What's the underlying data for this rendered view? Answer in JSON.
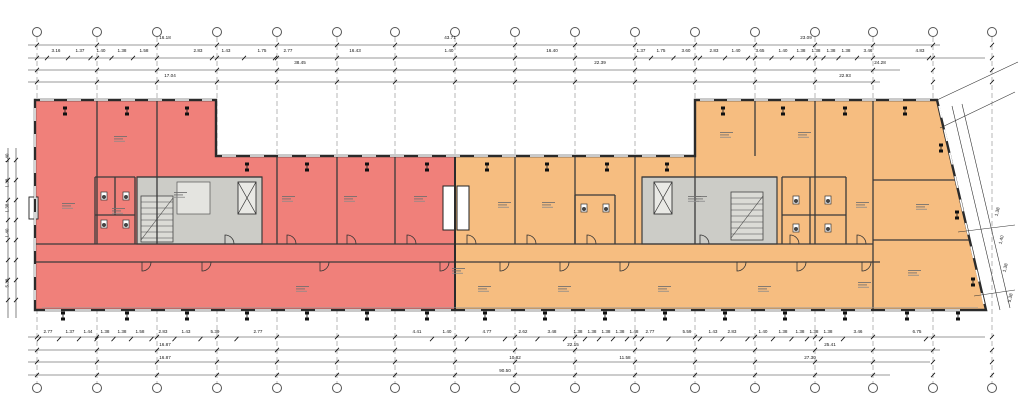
{
  "drawing": {
    "kind": "architectural-floor-plan",
    "zones": [
      {
        "id": "west-wing",
        "color": "#f0807a"
      },
      {
        "id": "east-wing",
        "color": "#f6bd80"
      }
    ],
    "core_color": "#ccccc7",
    "stair_color": "#dbdbd6",
    "grid_bubble_count": 17
  },
  "dimensions": {
    "top_rows": [
      {
        "y": 39,
        "chain": false,
        "labels": [
          {
            "t": "16.18",
            "x": 165
          },
          {
            "t": "43.71",
            "x": 450
          },
          {
            "t": "23.09",
            "x": 806
          }
        ]
      },
      {
        "y": 52,
        "chain": true,
        "labels": [
          {
            "t": "3.16",
            "x": 56
          },
          {
            "t": "1.37",
            "x": 80
          },
          {
            "t": "1.40",
            "x": 101
          },
          {
            "t": "1.38",
            "x": 122
          },
          {
            "t": "1.58",
            "x": 144
          },
          {
            "t": "2.83",
            "x": 198
          },
          {
            "t": "1.43",
            "x": 226
          },
          {
            "t": "1.75",
            "x": 262
          },
          {
            "t": "2.77",
            "x": 288
          },
          {
            "t": "16.43",
            "x": 355
          },
          {
            "t": "1.40",
            "x": 449
          },
          {
            "t": "16.40",
            "x": 552
          },
          {
            "t": "1.37",
            "x": 641
          },
          {
            "t": "1.75",
            "x": 661
          },
          {
            "t": "3.60",
            "x": 686
          },
          {
            "t": "2.83",
            "x": 714
          },
          {
            "t": "1.40",
            "x": 736
          },
          {
            "t": "3.65",
            "x": 760
          },
          {
            "t": "1.40",
            "x": 783
          },
          {
            "t": "1.38",
            "x": 801
          },
          {
            "t": "1.38",
            "x": 816
          },
          {
            "t": "1.38",
            "x": 831
          },
          {
            "t": "1.38",
            "x": 846
          },
          {
            "t": "3.46",
            "x": 868
          },
          {
            "t": "4.83",
            "x": 920
          }
        ]
      },
      {
        "y": 64,
        "chain": false,
        "labels": [
          {
            "t": "38.45",
            "x": 300
          },
          {
            "t": "22.39",
            "x": 600
          },
          {
            "t": "24.28",
            "x": 880
          }
        ]
      },
      {
        "y": 77,
        "chain": false,
        "labels": [
          {
            "t": "17.04",
            "x": 170
          },
          {
            "t": "22.93",
            "x": 845
          }
        ]
      }
    ],
    "bottom_rows": [
      {
        "y": 333,
        "chain": true,
        "labels": [
          {
            "t": "2.77",
            "x": 48
          },
          {
            "t": "1.37",
            "x": 70
          },
          {
            "t": "1.44",
            "x": 88
          },
          {
            "t": "1.38",
            "x": 105
          },
          {
            "t": "1.38",
            "x": 122
          },
          {
            "t": "1.58",
            "x": 140
          },
          {
            "t": "2.83",
            "x": 163
          },
          {
            "t": "1.43",
            "x": 186
          },
          {
            "t": "5.39",
            "x": 215
          },
          {
            "t": "2.77",
            "x": 258
          },
          {
            "t": "4.41",
            "x": 417
          },
          {
            "t": "1.40",
            "x": 447
          },
          {
            "t": "4.77",
            "x": 487
          },
          {
            "t": "2.62",
            "x": 523
          },
          {
            "t": "3.48",
            "x": 552
          },
          {
            "t": "1.38",
            "x": 578
          },
          {
            "t": "1.38",
            "x": 592
          },
          {
            "t": "1.38",
            "x": 606
          },
          {
            "t": "1.38",
            "x": 620
          },
          {
            "t": "1.48",
            "x": 634
          },
          {
            "t": "2.77",
            "x": 650
          },
          {
            "t": "5.59",
            "x": 687
          },
          {
            "t": "1.43",
            "x": 713
          },
          {
            "t": "2.83",
            "x": 732
          },
          {
            "t": "1.40",
            "x": 763
          },
          {
            "t": "1.38",
            "x": 783
          },
          {
            "t": "1.38",
            "x": 800
          },
          {
            "t": "1.38",
            "x": 814
          },
          {
            "t": "1.38",
            "x": 828
          },
          {
            "t": "3.46",
            "x": 858
          },
          {
            "t": "6.75",
            "x": 917
          }
        ]
      },
      {
        "y": 346,
        "chain": false,
        "labels": [
          {
            "t": "16.87",
            "x": 165
          },
          {
            "t": "22.15",
            "x": 573
          },
          {
            "t": "25.41",
            "x": 830
          }
        ]
      },
      {
        "y": 359,
        "chain": false,
        "labels": [
          {
            "t": "16.87",
            "x": 165
          },
          {
            "t": "10.82",
            "x": 515
          },
          {
            "t": "11.58",
            "x": 625
          },
          {
            "t": "27.30",
            "x": 810
          }
        ]
      },
      {
        "y": 372,
        "chain": false,
        "labels": [
          {
            "t": "90.50",
            "x": 505
          }
        ]
      }
    ],
    "left_column": [
      {
        "t": "1.40",
        "x": 8,
        "y": 158
      },
      {
        "t": "1.38",
        "x": 8,
        "y": 183
      },
      {
        "t": "1.38",
        "x": 8,
        "y": 208
      },
      {
        "t": "1.40",
        "x": 8,
        "y": 233
      },
      {
        "t": "5.38",
        "x": 8,
        "y": 283
      }
    ],
    "right_column": [
      {
        "t": "1.38",
        "x": 998,
        "y": 212
      },
      {
        "t": "1.40",
        "x": 1002,
        "y": 240
      },
      {
        "t": "1.38",
        "x": 1006,
        "y": 268
      },
      {
        "t": "5.38",
        "x": 1011,
        "y": 298
      }
    ]
  }
}
